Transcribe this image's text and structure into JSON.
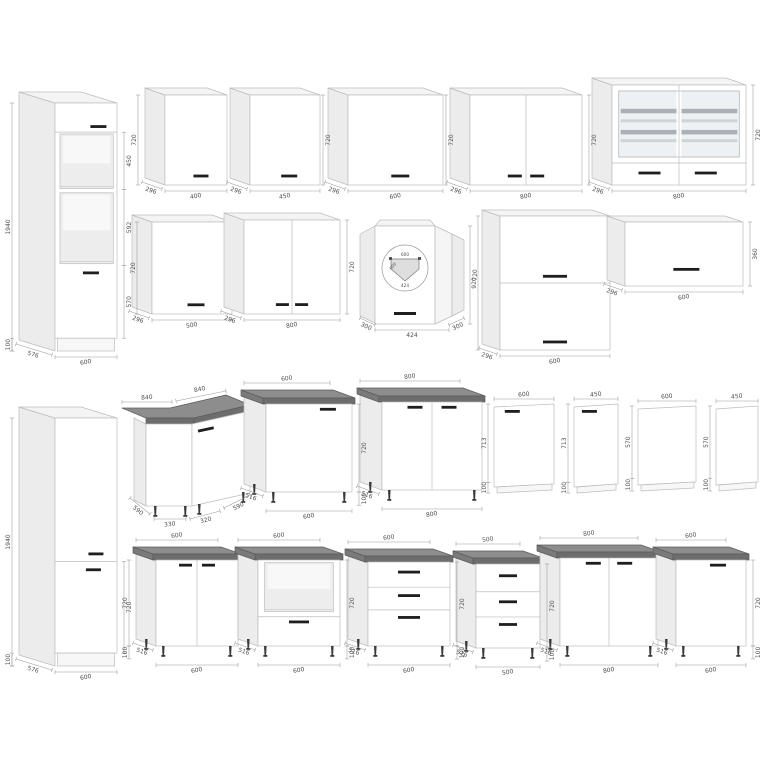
{
  "page": {
    "description": "Kitchen cabinet set technical drawing with millimetre dimensions"
  },
  "palette": {
    "edge": "#bdbdbd",
    "front": "#ffffff",
    "front2": "#f7f7f7",
    "frontShade": "#f5f5f5",
    "side": "#ececec",
    "top": "#f4f4f4",
    "niche": "#ededed",
    "nicheBack": "#f8f8f8",
    "glass": "#eef1f3",
    "shelfA": "#aab0b5",
    "shelfB": "#ced3d6",
    "wtTop": "#8d8d8d",
    "wtFront": "#6d6d6d",
    "wtSide": "#7a7a7a",
    "wtEdge": "#5c5c5c",
    "handle": "#1e1e1e",
    "leg": "#3a3a3a",
    "dim": "#9a9a9a",
    "dimText": "#4f4f4f",
    "plan": "#dedede"
  },
  "diagram": {
    "canvas": {
      "width": 768,
      "height": 768
    },
    "cabinets": [
      {
        "name": "tall-oven-housing-cabinet",
        "kind": "box",
        "x": 55,
        "y": 103,
        "w": 62,
        "h": 248,
        "dx": 36,
        "dy": 11,
        "plinth": 0.9485,
        "hlines": [
          0.1175
        ],
        "openings": [
          {
            "x0": 0.08,
            "x1": 0.94,
            "y0": 0.125,
            "y1": 0.345
          },
          {
            "x0": 0.08,
            "x1": 0.94,
            "y0": 0.362,
            "y1": 0.648
          }
        ],
        "handles": [
          {
            "x": 0.7,
            "y": 0.095,
            "l": 16
          },
          {
            "x": 0.58,
            "y": 0.685,
            "l": 16
          }
        ],
        "dims": {
          "left": [
            [
              0,
              1,
              "1940"
            ],
            [
              0.9485,
              1,
              "100"
            ]
          ],
          "right": [
            [
              0.1175,
              0.3495,
              "450"
            ],
            [
              0.3495,
              0.6546,
              "592"
            ],
            [
              0.6546,
              0.9485,
              "570"
            ]
          ],
          "bottom": "600",
          "depth": "576"
        }
      },
      {
        "name": "wall-cabinet-400",
        "kind": "box",
        "x": 165,
        "y": 95,
        "w": 62,
        "h": 90,
        "dx": 20,
        "dy": 7,
        "handles": [
          {
            "x": 0.58,
            "y": 0.9,
            "l": 15
          }
        ],
        "dims": {
          "left": [
            [
              0,
              1,
              "720"
            ]
          ],
          "bottom": "400",
          "depth": "296"
        }
      },
      {
        "name": "wall-cabinet-450",
        "kind": "box",
        "x": 250,
        "y": 95,
        "w": 70,
        "h": 90,
        "dx": 20,
        "dy": 7,
        "handles": [
          {
            "x": 0.56,
            "y": 0.9,
            "l": 16
          }
        ],
        "dims": {
          "right": [
            [
              0,
              1,
              "720",
              -4
            ]
          ],
          "bottom": "450",
          "depth": "296"
        }
      },
      {
        "name": "wall-cabinet-600",
        "kind": "box",
        "x": 348,
        "y": 95,
        "w": 95,
        "h": 90,
        "dx": 20,
        "dy": 7,
        "handles": [
          {
            "x": 0.55,
            "y": 0.9,
            "l": 18
          }
        ],
        "dims": {
          "right": [
            [
              0,
              1,
              "720",
              -4
            ]
          ],
          "bottom": "600",
          "depth": "296"
        }
      },
      {
        "name": "wall-cabinet-800-double",
        "kind": "box",
        "x": 470,
        "y": 95,
        "w": 112,
        "h": 90,
        "dx": 20,
        "dy": 7,
        "vlines": [
          0.5
        ],
        "handles": [
          {
            "x": 0.4,
            "y": 0.9,
            "l": 14
          },
          {
            "x": 0.6,
            "y": 0.9,
            "l": 14
          }
        ],
        "dims": {
          "right": [
            [
              0,
              1,
              "720"
            ]
          ],
          "bottom": "800",
          "depth": "296"
        }
      },
      {
        "name": "wall-cabinet-800-glass",
        "kind": "box",
        "x": 612,
        "y": 85,
        "w": 134,
        "h": 100,
        "dx": 20,
        "dy": 7,
        "vlines": [
          0.5
        ],
        "hlines": [
          0.78
        ],
        "glass": {
          "x0": 0.05,
          "x1": 0.95,
          "y0": 0.06,
          "y1": 0.72,
          "shelves": [
            0.3,
            0.46,
            0.62,
            0.76
          ]
        },
        "handles": [
          {
            "x": 0.28,
            "y": 0.88,
            "l": 22
          },
          {
            "x": 0.7,
            "y": 0.88,
            "l": 22
          }
        ],
        "dims": {
          "right": [
            [
              0,
              1,
              "720"
            ]
          ],
          "bottom": "800",
          "depth": "296"
        }
      },
      {
        "name": "wall-cabinet-500",
        "kind": "box",
        "x": 152,
        "y": 222,
        "w": 80,
        "h": 92,
        "dx": 20,
        "dy": 7,
        "handles": [
          {
            "x": 0.55,
            "y": 0.9,
            "l": 17
          }
        ],
        "dims": {
          "left": [
            [
              0,
              1,
              "720",
              -12
            ]
          ],
          "bottom": "500",
          "depth": "296"
        }
      },
      {
        "name": "wall-cabinet-800-double-b",
        "kind": "box",
        "x": 244,
        "y": 220,
        "w": 96,
        "h": 94,
        "dx": 20,
        "dy": 7,
        "vlines": [
          0.5
        ],
        "handles": [
          {
            "x": 0.4,
            "y": 0.9,
            "l": 13
          },
          {
            "x": 0.6,
            "y": 0.9,
            "l": 13
          }
        ],
        "dims": {
          "right": [
            [
              0,
              1,
              "720"
            ]
          ],
          "bottom": "800",
          "depth": "296"
        }
      },
      {
        "name": "wall-corner-cabinet-600",
        "kind": "corner-wall",
        "x": 360,
        "y": 222,
        "w": 104,
        "h": 106,
        "labels": {
          "height": "720",
          "front": "424",
          "side": "300",
          "plan": [
            "600",
            "600",
            "424"
          ]
        }
      },
      {
        "name": "wall-cabinet-flip-double-600",
        "kind": "box",
        "x": 500,
        "y": 216,
        "w": 110,
        "h": 134,
        "dx": 18,
        "dy": 6,
        "hlines": [
          0.5
        ],
        "handles": [
          {
            "x": 0.5,
            "y": 0.45,
            "l": 24
          },
          {
            "x": 0.5,
            "y": 0.94,
            "l": 24
          }
        ],
        "dims": {
          "left": [
            [
              0,
              1,
              "920",
              -3
            ]
          ],
          "bottom": "600",
          "depth": "296"
        }
      },
      {
        "name": "wall-cabinet-flip-600",
        "kind": "box",
        "x": 625,
        "y": 222,
        "w": 118,
        "h": 64,
        "dx": 18,
        "dy": 6,
        "handles": [
          {
            "x": 0.52,
            "y": 0.74,
            "l": 26
          }
        ],
        "dims": {
          "right": [
            [
              0,
              1,
              "360"
            ]
          ],
          "bottom": "600",
          "depth": "296"
        }
      },
      {
        "name": "tall-fridge-housing-cabinet",
        "kind": "box",
        "x": 55,
        "y": 418,
        "w": 62,
        "h": 248,
        "dx": 36,
        "dy": 11,
        "plinth": 0.948,
        "hlines": [
          0.578
        ],
        "handles": [
          {
            "x": 0.66,
            "y": 0.548,
            "l": 15
          },
          {
            "x": 0.62,
            "y": 0.612,
            "l": 15
          }
        ],
        "dims": {
          "left": [
            [
              0,
              1,
              "1940"
            ],
            [
              0.948,
              1,
              "100"
            ]
          ],
          "right": [
            [
              0.578,
              0.948,
              "720"
            ]
          ],
          "bottom": "600",
          "depth": "576"
        }
      },
      {
        "name": "base-corner-cabinet-840",
        "kind": "corner-base",
        "x": 128,
        "y": 392,
        "labels": {
          "top": [
            "840",
            "840"
          ],
          "bottom": [
            "590",
            "330",
            "320",
            "590"
          ]
        }
      },
      {
        "name": "base-cabinet-600-door",
        "kind": "box",
        "x": 266,
        "y": 404,
        "w": 86,
        "h": 88,
        "dx": 22,
        "dy": 8,
        "worktop": true,
        "legs": true,
        "handles": [
          {
            "x": 0.72,
            "y": 0.06,
            "l": 16
          }
        ],
        "dims": {
          "top": "600",
          "right": [
            [
              0,
              1,
              "720"
            ],
            [
              1,
              1.15,
              "100"
            ]
          ],
          "bottom": "600",
          "depth": "516"
        }
      },
      {
        "name": "base-cabinet-800-double",
        "kind": "box",
        "x": 382,
        "y": 402,
        "w": 100,
        "h": 88,
        "dx": 22,
        "dy": 8,
        "worktop": true,
        "legs": true,
        "vlines": [
          0.5
        ],
        "handles": [
          {
            "x": 0.33,
            "y": 0.06,
            "l": 15
          },
          {
            "x": 0.67,
            "y": 0.06,
            "l": 15
          }
        ],
        "dims": {
          "top": "800",
          "bottom": "800",
          "depth": "516"
        }
      },
      {
        "name": "dishwasher-front-600",
        "kind": "panel",
        "x": 494,
        "y": 404,
        "w": 60,
        "h": 82,
        "handle": true,
        "dims": {
          "top": "600",
          "left": [
            [
              0,
              0.88,
              "713"
            ],
            [
              0.88,
              1,
              "100"
            ]
          ]
        }
      },
      {
        "name": "dishwasher-front-450",
        "kind": "panel",
        "x": 574,
        "y": 404,
        "w": 44,
        "h": 82,
        "handle": true,
        "dims": {
          "top": "450",
          "left": [
            [
              0,
              0.88,
              "713"
            ],
            [
              0.88,
              1,
              "100"
            ]
          ]
        }
      },
      {
        "name": "end-panel-600",
        "kind": "panel",
        "x": 638,
        "y": 406,
        "w": 58,
        "h": 78,
        "dims": {
          "top": "600",
          "left": [
            [
              0,
              0.85,
              "570"
            ],
            [
              0.85,
              1,
              "100"
            ]
          ]
        }
      },
      {
        "name": "end-panel-450",
        "kind": "panel",
        "x": 716,
        "y": 406,
        "w": 42,
        "h": 78,
        "dims": {
          "top": "450",
          "left": [
            [
              0,
              0.85,
              "570"
            ],
            [
              0.85,
              1,
              "100"
            ]
          ]
        }
      },
      {
        "name": "base-cabinet-600-double",
        "kind": "box",
        "x": 156,
        "y": 560,
        "w": 82,
        "h": 86,
        "dx": 20,
        "dy": 7,
        "worktop": true,
        "legs": true,
        "vlines": [
          0.5
        ],
        "handles": [
          {
            "x": 0.36,
            "y": 0.06,
            "l": 13
          },
          {
            "x": 0.64,
            "y": 0.06,
            "l": 13
          }
        ],
        "dims": {
          "left": [
            [
              0,
              1,
              "720"
            ],
            [
              1,
              1.15,
              "100"
            ]
          ],
          "top": "600",
          "bottom": "600",
          "depth": "516"
        }
      },
      {
        "name": "base-oven-housing-600",
        "kind": "box",
        "x": 258,
        "y": 560,
        "w": 82,
        "h": 86,
        "dx": 20,
        "dy": 7,
        "worktop": true,
        "legs": true,
        "openings": [
          {
            "x0": 0.08,
            "x1": 0.92,
            "y0": 0.03,
            "y1": 0.6
          }
        ],
        "hlines": [
          0.66
        ],
        "handles": [
          {
            "x": 0.5,
            "y": 0.72,
            "l": 20
          }
        ],
        "dims": {
          "right": [
            [
              0,
              1,
              "720"
            ],
            [
              1,
              1.15,
              "100"
            ]
          ],
          "top": "600",
          "bottom": "600",
          "depth": "516"
        }
      },
      {
        "name": "base-drawer-cabinet-600",
        "kind": "box",
        "x": 368,
        "y": 562,
        "w": 82,
        "h": 84,
        "dx": 20,
        "dy": 7,
        "worktop": true,
        "legs": true,
        "hlines": [
          0.3,
          0.57
        ],
        "handles": [
          {
            "x": 0.5,
            "y": 0.12,
            "l": 22
          },
          {
            "x": 0.5,
            "y": 0.4,
            "l": 22
          },
          {
            "x": 0.5,
            "y": 0.66,
            "l": 22
          }
        ],
        "dims": {
          "top": "600",
          "right": [
            [
              0,
              1,
              "720"
            ],
            [
              1,
              1.155,
              "100"
            ]
          ],
          "bottom": "600",
          "depth": "516"
        }
      },
      {
        "name": "base-drawer-cabinet-500",
        "kind": "box",
        "x": 476,
        "y": 564,
        "w": 64,
        "h": 84,
        "dx": 20,
        "dy": 7,
        "worktop": true,
        "legs": true,
        "hlines": [
          0.33,
          0.63
        ],
        "handles": [
          {
            "x": 0.5,
            "y": 0.14,
            "l": 18
          },
          {
            "x": 0.5,
            "y": 0.45,
            "l": 18
          },
          {
            "x": 0.5,
            "y": 0.72,
            "l": 18
          }
        ],
        "dims": {
          "top": "500",
          "right": [
            [
              0,
              1,
              "720"
            ],
            [
              1,
              1.155,
              "100"
            ]
          ],
          "bottom": "500",
          "depth": "516"
        }
      },
      {
        "name": "base-cabinet-800-double-b",
        "kind": "box",
        "x": 560,
        "y": 558,
        "w": 98,
        "h": 88,
        "dx": 20,
        "dy": 7,
        "worktop": true,
        "legs": true,
        "vlines": [
          0.5
        ],
        "handles": [
          {
            "x": 0.34,
            "y": 0.06,
            "l": 15
          },
          {
            "x": 0.66,
            "y": 0.06,
            "l": 15
          }
        ],
        "dims": {
          "top": "800",
          "bottom": "800",
          "depth": "516"
        }
      },
      {
        "name": "base-cabinet-600-door-b",
        "kind": "box",
        "x": 676,
        "y": 560,
        "w": 70,
        "h": 86,
        "dx": 20,
        "dy": 7,
        "worktop": true,
        "legs": true,
        "handles": [
          {
            "x": 0.6,
            "y": 0.06,
            "l": 16
          }
        ],
        "dims": {
          "top": "600",
          "right": [
            [
              0,
              1,
              "720"
            ],
            [
              1,
              1.15,
              "100"
            ]
          ],
          "bottom": "600",
          "depth": "516"
        }
      }
    ]
  }
}
